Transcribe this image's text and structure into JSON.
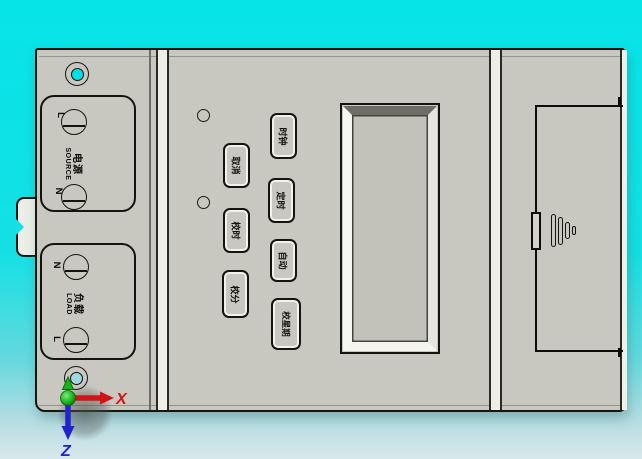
{
  "viewport": {
    "background_top": "#06e4e8",
    "background_bottom": "#d8e8ea"
  },
  "device": {
    "body_color": "#c8c8c0",
    "terminals": {
      "source": {
        "top_label": "L",
        "bottom_label": "N",
        "cn": "电源",
        "en": "SOURCE"
      },
      "load": {
        "top_label": "N",
        "bottom_label": "L",
        "cn": "负载",
        "en": "LOAD"
      }
    },
    "buttons": [
      {
        "label": "取消"
      },
      {
        "label": "校时"
      },
      {
        "label": "校分"
      },
      {
        "label": "时钟"
      },
      {
        "label": "定时"
      },
      {
        "label": "自动"
      },
      {
        "label": "校星期"
      }
    ],
    "colors": {
      "through_hole": "#00e0e4",
      "bottom_hole": "#a2d6e0",
      "axis_x": "#d41414",
      "axis_z": "#2222d2",
      "axis_origin": "#17b517"
    }
  },
  "axes": {
    "x_label": "X",
    "z_label": "Z"
  }
}
